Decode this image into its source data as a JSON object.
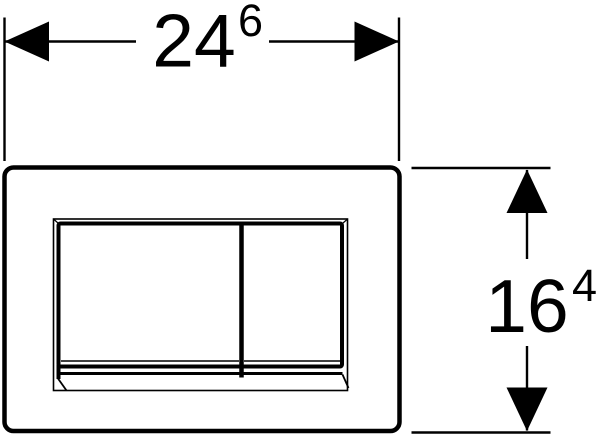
{
  "drawing": {
    "line_color": "#000000",
    "background_color": "#ffffff"
  },
  "dimensions": {
    "width": {
      "value": "24",
      "superscript": "6"
    },
    "height": {
      "value": "16",
      "superscript": "4"
    }
  }
}
